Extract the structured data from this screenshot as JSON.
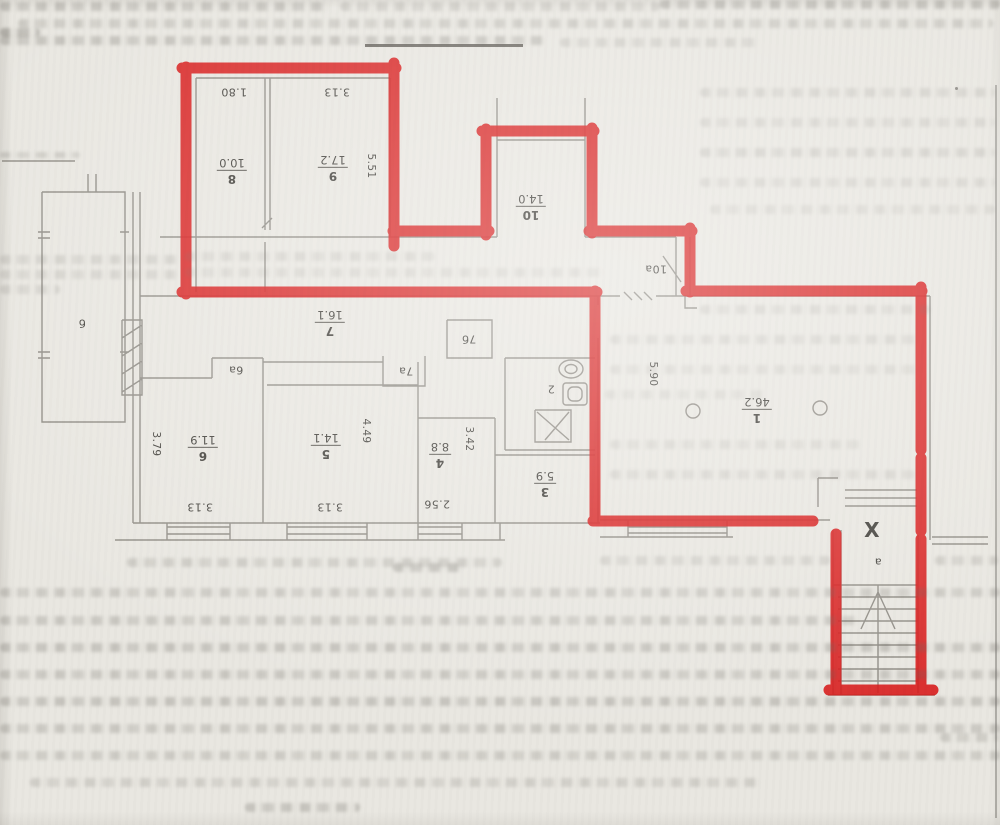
{
  "plan_labels": {
    "room_fractions": [
      {
        "number": "8",
        "area": "10.0"
      },
      {
        "number": "9",
        "area": "17.2"
      },
      {
        "number": "10",
        "area": "14.0"
      },
      {
        "number": "7",
        "area": "16.1"
      },
      {
        "number": "6",
        "area": "11.9"
      },
      {
        "number": "5",
        "area": "14.1"
      },
      {
        "number": "4",
        "area": "8.8"
      },
      {
        "number": "3",
        "area": "5.9"
      },
      {
        "number": "1",
        "area": "46.2"
      }
    ],
    "plain": [
      "1.80",
      "3.13",
      "2",
      "10а",
      "6а",
      "7а",
      "7б",
      "б",
      "а",
      "3.13",
      "3.13",
      "2.56",
      "X"
    ],
    "vertical_dims": [
      "5.51",
      "5.90",
      "4.49",
      "3.42",
      "3.79"
    ]
  },
  "annotation": {
    "marker_color": "#d81d1d"
  }
}
